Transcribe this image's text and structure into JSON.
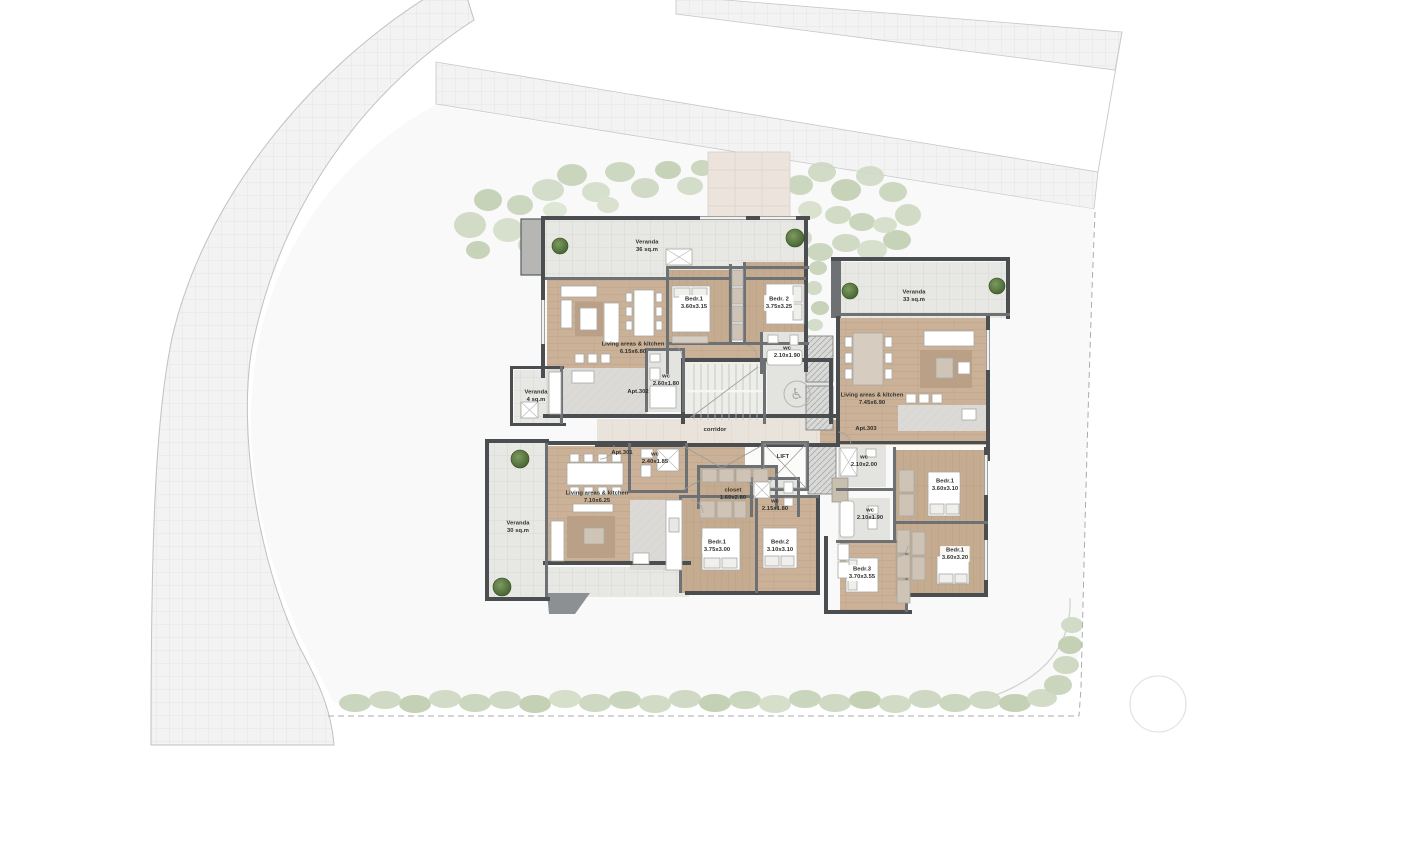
{
  "plan": {
    "apartments": [
      {
        "id": "Apt.302",
        "rooms": [
          {
            "name": "Veranda",
            "dims": "36 sq.m"
          },
          {
            "name": "Bedr.1",
            "dims": "3.60x3.15"
          },
          {
            "name": "Bedr. 2",
            "dims": "3.75x3.25"
          },
          {
            "name": "Living areas & kitchen",
            "dims": "6.15x6.80"
          },
          {
            "name": "wc",
            "dims": "2.10x1.90"
          },
          {
            "name": "wc",
            "dims": "2.60x1.80"
          },
          {
            "name": "Veranda",
            "dims": "4 sq.m"
          }
        ]
      },
      {
        "id": "Apt.303",
        "rooms": [
          {
            "name": "Veranda",
            "dims": "33 sq.m"
          },
          {
            "name": "Living areas & kitchen",
            "dims": "7.45x6.90"
          },
          {
            "name": "wc",
            "dims": "2.10x2.00"
          },
          {
            "name": "Bedr.1",
            "dims": "3.60x3.10"
          },
          {
            "name": "wc",
            "dims": "2.10x1.90"
          },
          {
            "name": "Bedr.1",
            "dims": "3.60x3.20"
          },
          {
            "name": "Bedr.3",
            "dims": "3.70x3.55"
          }
        ]
      },
      {
        "id": "Apt.301",
        "rooms": [
          {
            "name": "Veranda",
            "dims": "30 sq.m"
          },
          {
            "name": "Living areas & kitchen",
            "dims": "7.10x6.25"
          },
          {
            "name": "wc",
            "dims": "2.40x1.85"
          },
          {
            "name": "closet",
            "dims": "1.60x2.80"
          },
          {
            "name": "wc",
            "dims": "2.15x1.80"
          },
          {
            "name": "Bedr.1",
            "dims": "3.75x3.00"
          },
          {
            "name": "Bedr.2",
            "dims": "3.10x3.10"
          }
        ]
      }
    ],
    "core": {
      "corridor": "corridor",
      "lift": "LIFT"
    },
    "icons": {
      "wheelchair": "♿"
    },
    "colors": {
      "road": "#f2f3f2",
      "road_grid": "#e4e5e5",
      "plot": "#f8f9f8",
      "veranda_tile": "#e7e7e4",
      "wood_floor": "#cab197",
      "wall": "#4b4e50",
      "corridor_tile": "#e9e3db",
      "vegetation": "#ccd7c0",
      "tree": "#4d6e3b",
      "marble": "#dbdad6"
    }
  }
}
